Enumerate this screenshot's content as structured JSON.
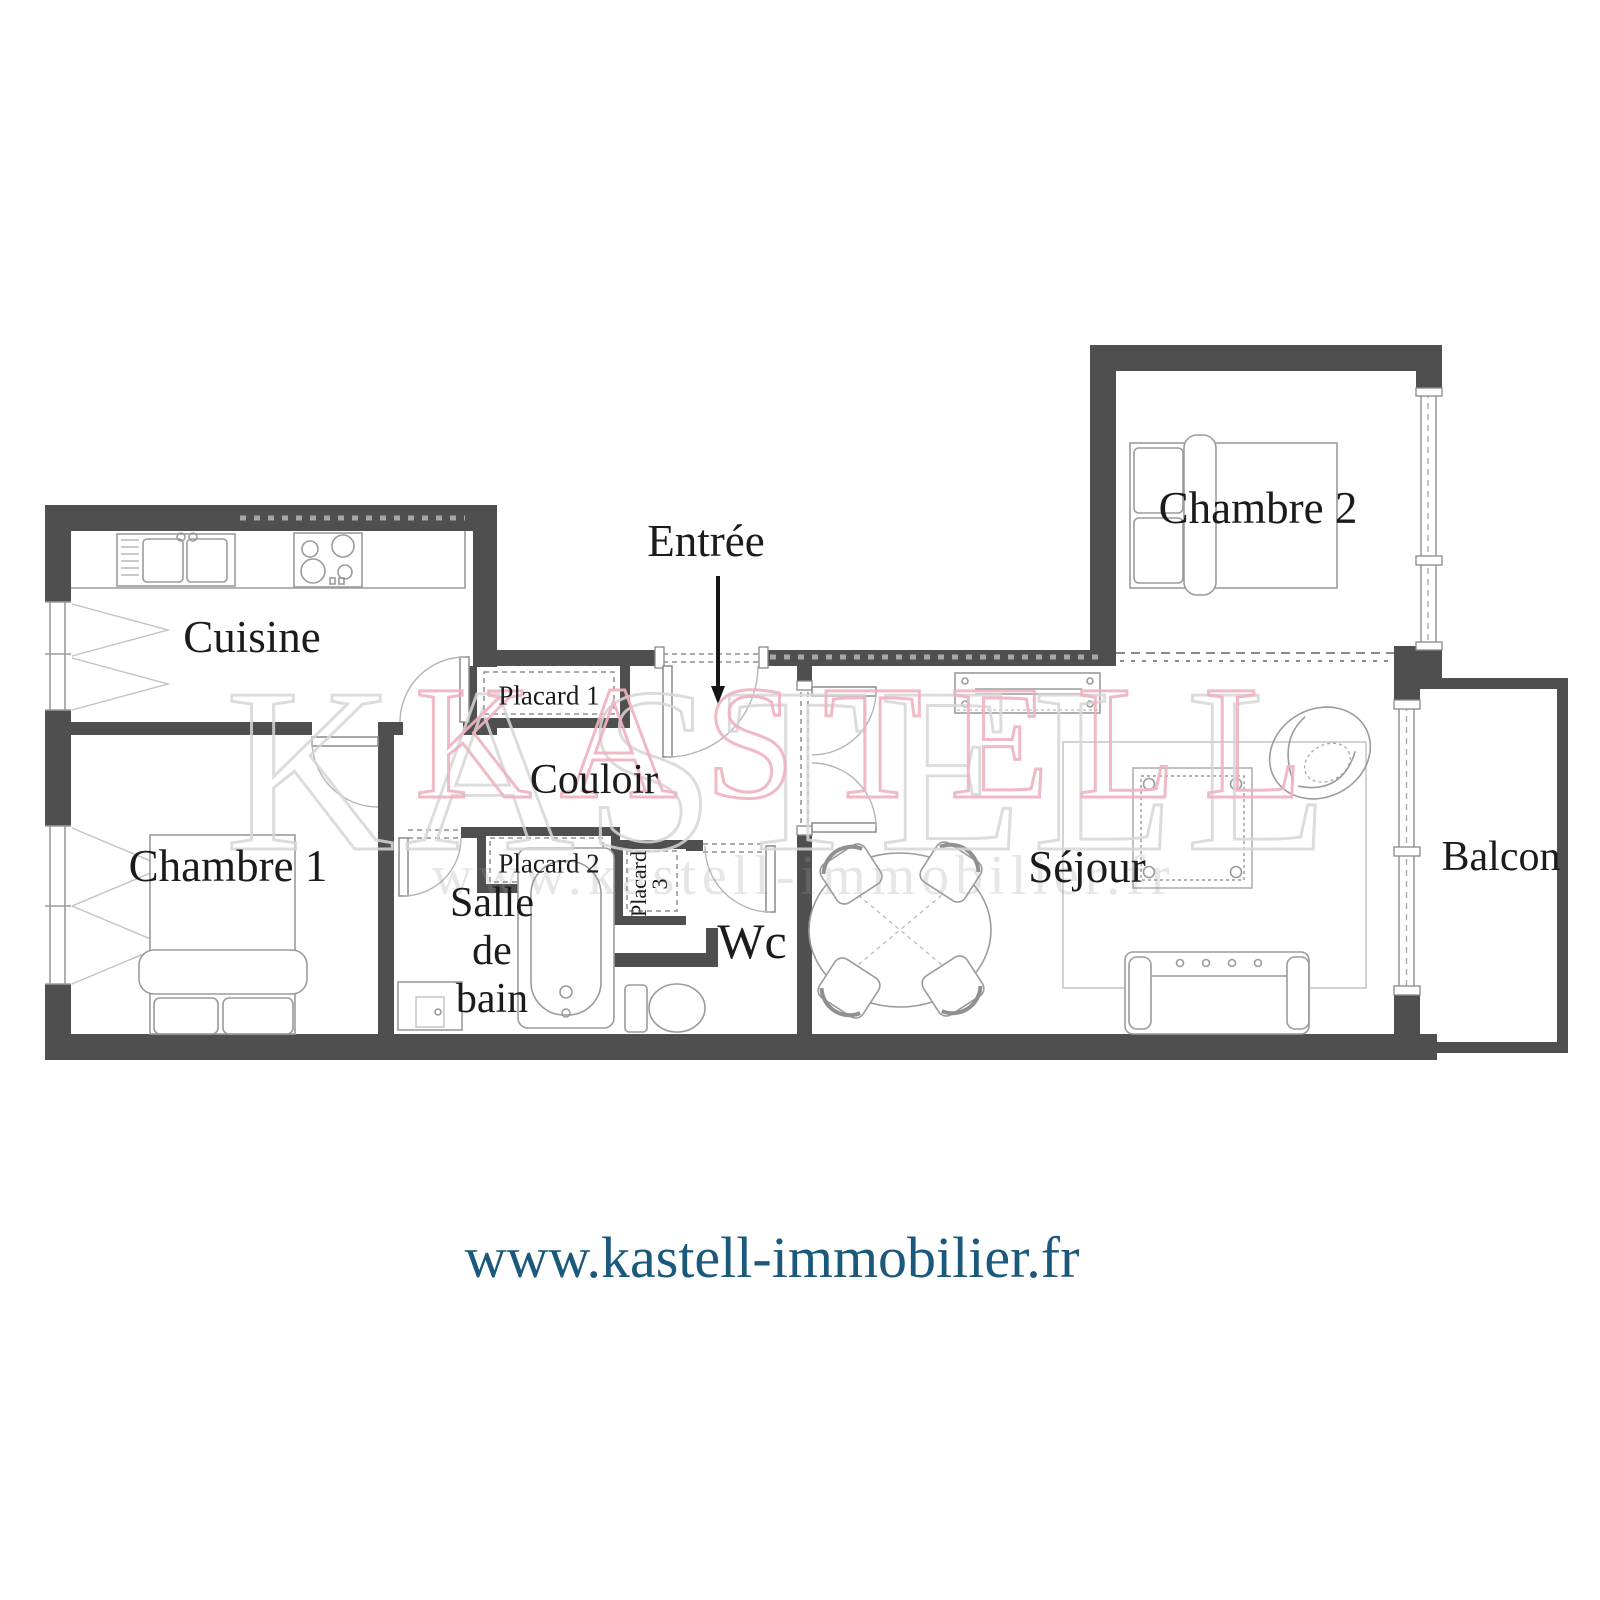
{
  "plan": {
    "rooms": {
      "cuisine": "Cuisine",
      "entree": "Entrée",
      "chambre2": "Chambre 2",
      "placard1": "Placard 1",
      "couloir": "Couloir",
      "placard2": "Placard 2",
      "placard3_line1": "Placard",
      "placard3_line2": "3",
      "chambre1": "Chambre 1",
      "salle_line1": "Salle",
      "salle_line2": "de",
      "salle_line3": "bain",
      "wc": "Wc",
      "sejour": "Séjour",
      "balcon": "Balcon"
    },
    "watermark": {
      "brand": "KASTELL",
      "faint_url": "www.kastell-immobilier.fr"
    },
    "colors": {
      "wall": "#4f4f4f",
      "watermark_pink": "#efb2bd",
      "watermark_gray": "#d7d7d7",
      "url_blue": "#1a587c"
    }
  },
  "footer": {
    "url": "www.kastell-immobilier.fr"
  }
}
